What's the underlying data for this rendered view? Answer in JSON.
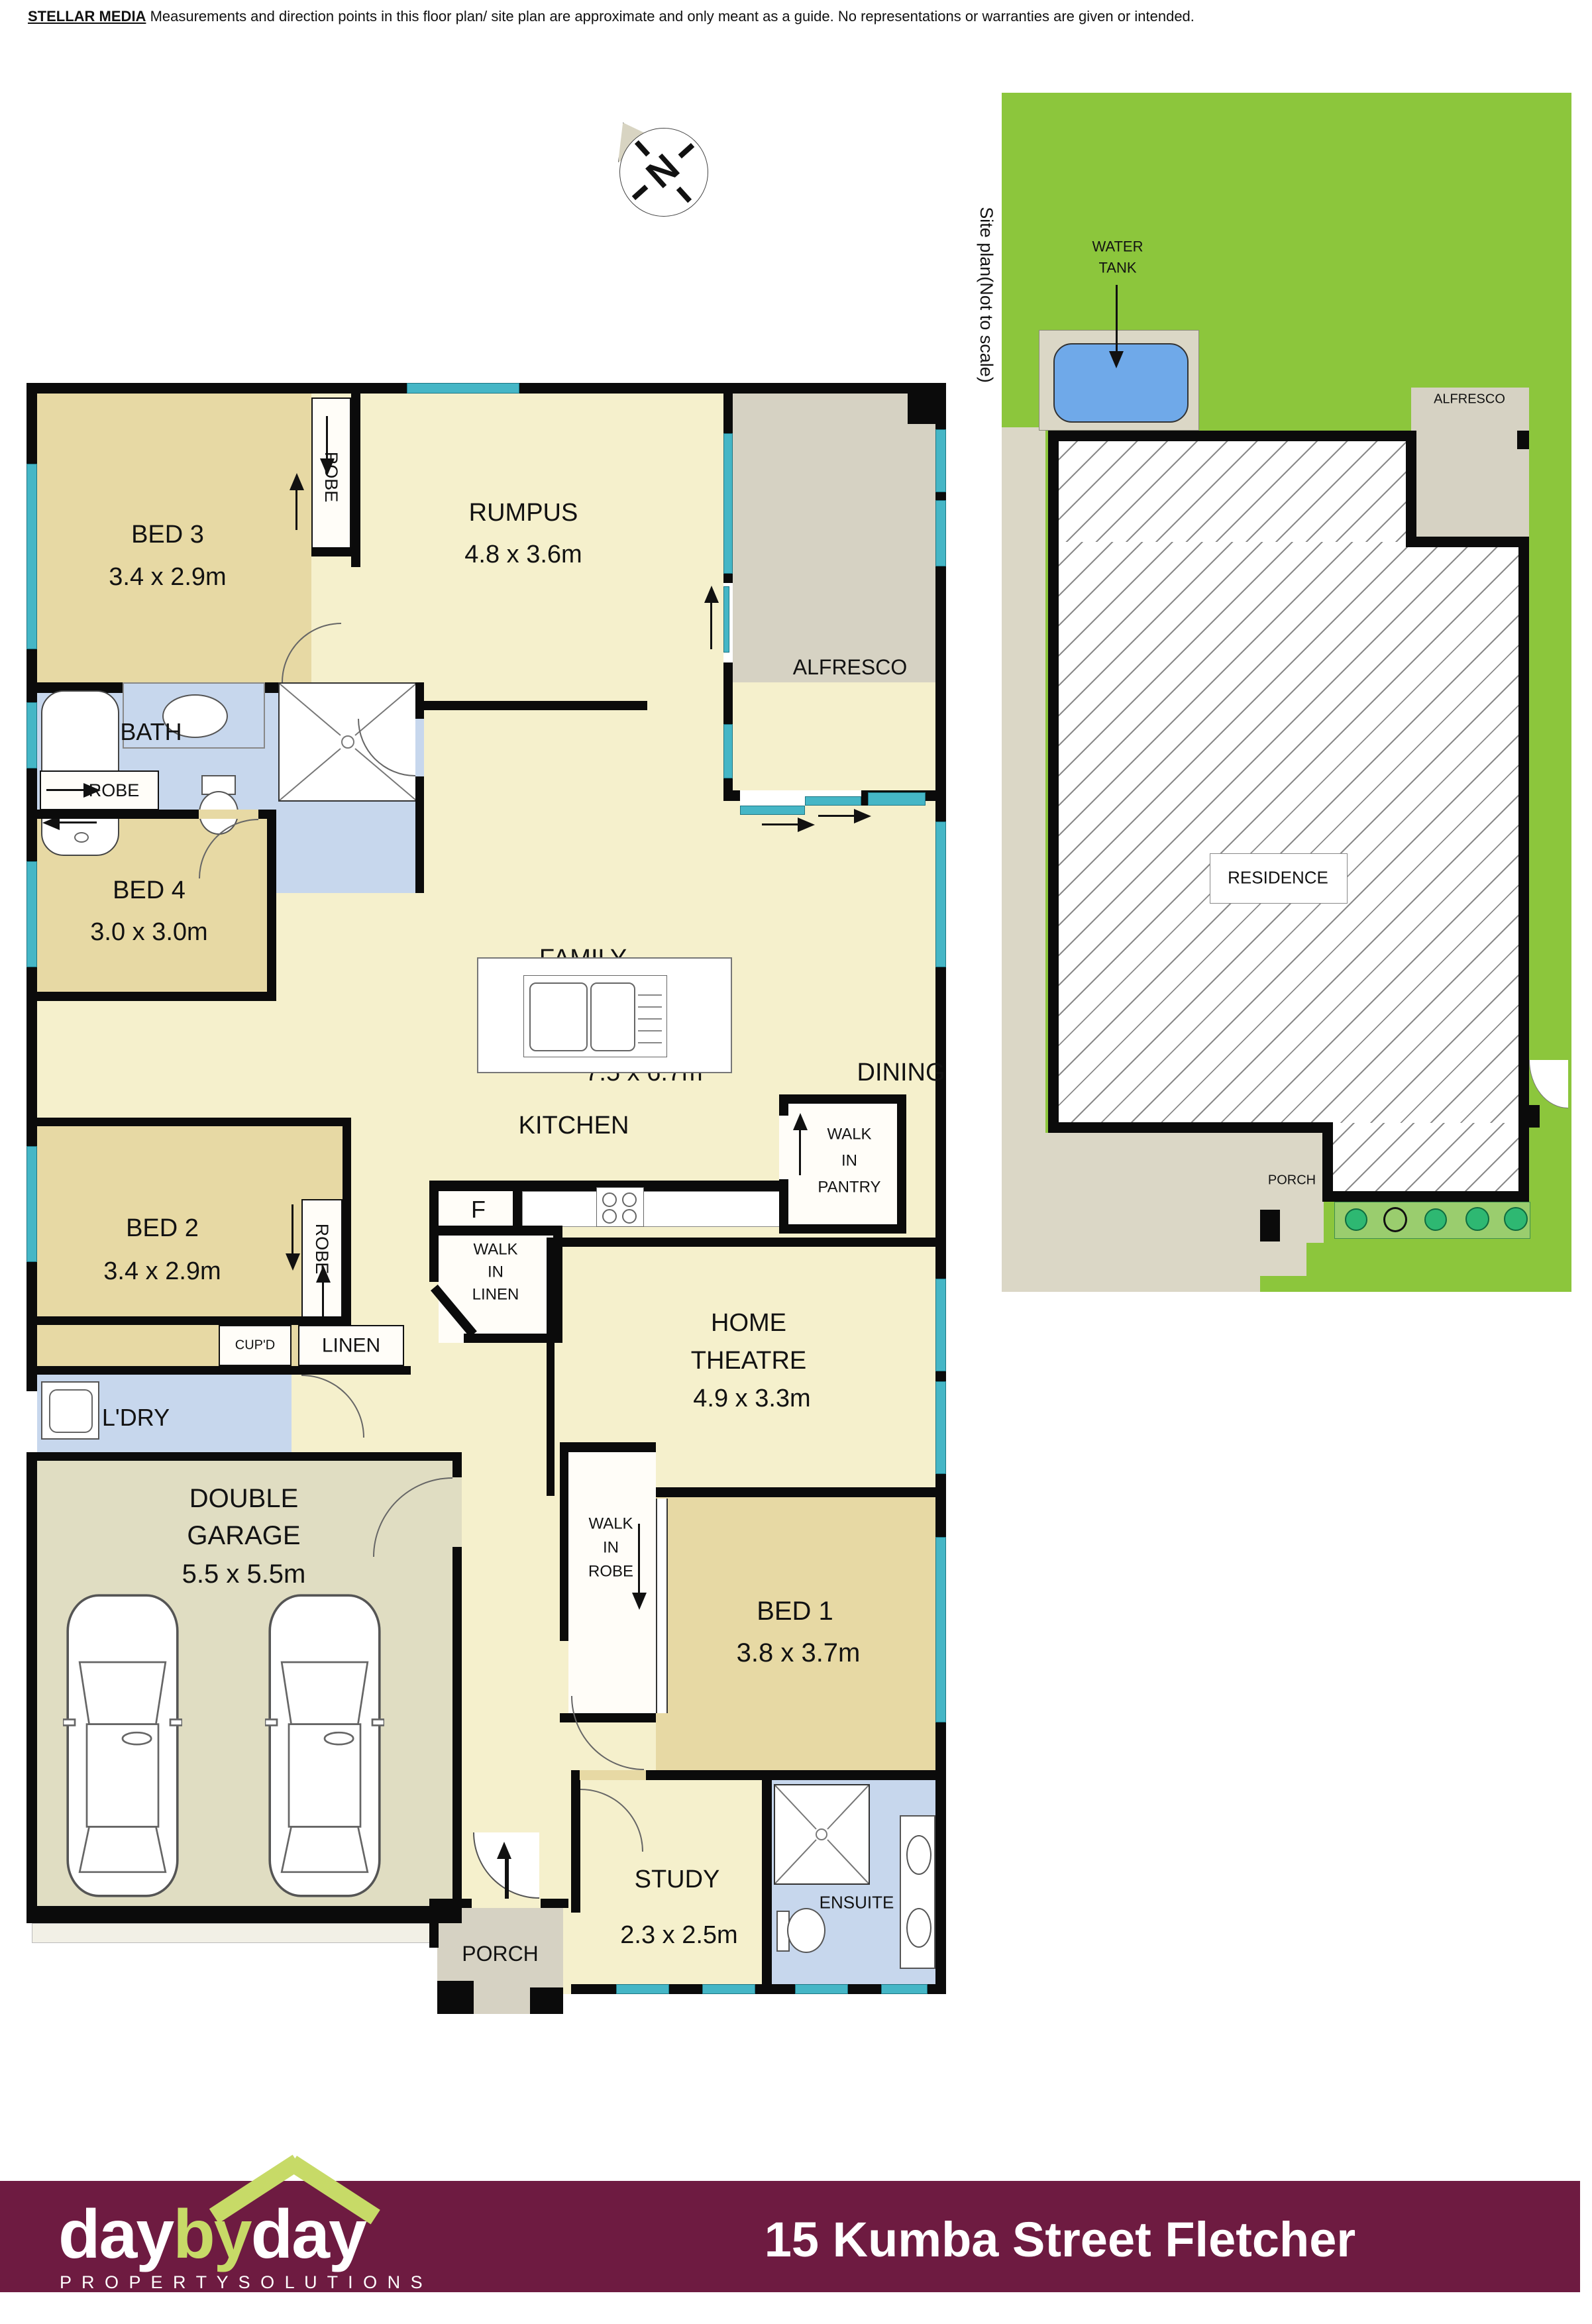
{
  "disclaimer": {
    "brand": "STELLAR MEDIA",
    "text": " Measurements and direction points in this floor plan/ site plan are approximate and only meant as a guide. No representations or warranties are given or intended."
  },
  "compass": {
    "letter": "N"
  },
  "rooms": {
    "bed3": {
      "n": "BED 3",
      "d": "3.4 x 2.9m"
    },
    "rumpus": {
      "n": "RUMPUS",
      "d": "4.8 x 3.6m"
    },
    "alfresco": "ALFRESCO",
    "bath": "BATH",
    "robe": "ROBE",
    "bed4": {
      "n": "BED 4",
      "d": "3.0 x 3.0m"
    },
    "family": {
      "n": "FAMILY",
      "d": "7.5 x 6.7m"
    },
    "dining": "DINING",
    "kitchen": "KITCHEN",
    "fridge": "F",
    "wip": {
      "l1": "WALK",
      "l2": "IN",
      "l3": "PANTRY"
    },
    "wil": {
      "l1": "WALK",
      "l2": "IN",
      "l3": "LINEN"
    },
    "wir": {
      "l1": "WALK",
      "l2": "IN",
      "l3": "ROBE"
    },
    "bed2": {
      "n": "BED 2",
      "d": "3.4 x 2.9m"
    },
    "cupd": "CUP'D",
    "linen": "LINEN",
    "ldry": "L'DRY",
    "theatre": {
      "l1": "HOME",
      "l2": "THEATRE",
      "d": "4.9 x 3.3m"
    },
    "garage": {
      "l1": "DOUBLE",
      "l2": "GARAGE",
      "d": "5.5 x 5.5m"
    },
    "bed1": {
      "n": "BED 1",
      "d": "3.8 x 3.7m"
    },
    "study": {
      "n": "STUDY",
      "d": "2.3 x 2.5m"
    },
    "ensuite": "ENSUITE",
    "porch": "PORCH"
  },
  "site_plan": {
    "title": "Site plan(Not to scale)",
    "water_tank_l1": "WATER",
    "water_tank_l2": "TANK",
    "alfresco": "ALFRESCO",
    "residence": "RESIDENCE",
    "porch": "PORCH"
  },
  "footer": {
    "logo_day1": "day",
    "logo_by": "by",
    "logo_day2": "day",
    "tagline": "P R O P E R T Y   S O L U T I O N S",
    "address": "15 Kumba Street Fletcher"
  },
  "colors": {
    "bedroom_tan": "#e7d9a4",
    "living_pale": "#f5f0cc",
    "wet_blue": "#c7d7ed",
    "alfresco_gray": "#d6d2c3",
    "garage_floor": "#e0ddc2",
    "window_teal": "#45b6c6",
    "site_green": "#8cc63c",
    "footer_maroon": "#6e1b41",
    "logo_green": "#c7da67"
  }
}
